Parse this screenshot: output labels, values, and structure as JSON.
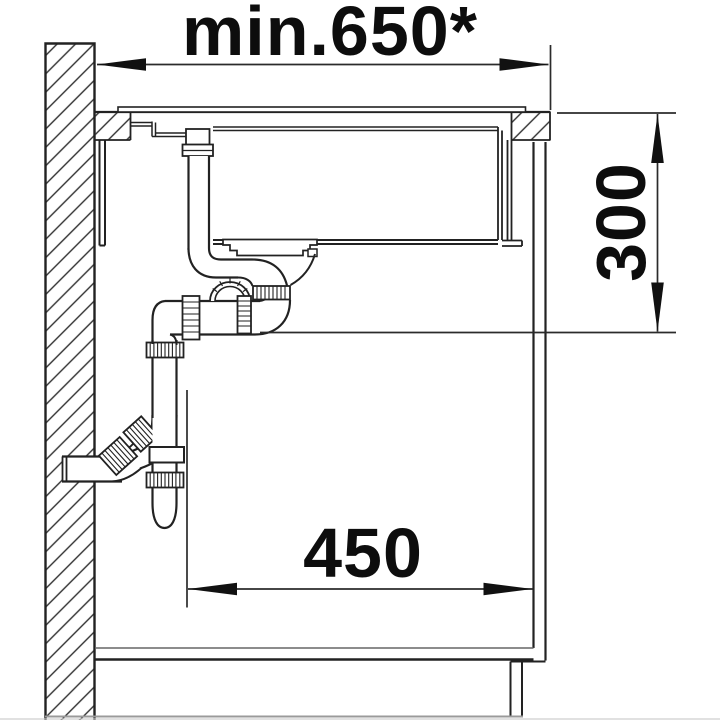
{
  "drawing": {
    "title": "sink-installation-cross-section",
    "dimensions": {
      "top_width": {
        "label": "min.650*",
        "orientation": "horizontal",
        "position": "top"
      },
      "bottom_width": {
        "label": "450",
        "orientation": "horizontal",
        "position": "bottom"
      },
      "right_height": {
        "label": "300",
        "orientation": "vertical",
        "position": "right"
      }
    },
    "colors": {
      "line": "#1f1f1f",
      "thin_line": "#3a3a3a",
      "dimension_line": "#2b2b2b",
      "text": "#0d0d0d",
      "ground": "#9a9a9a",
      "background": "#ffffff"
    },
    "elements": [
      "hatched-wall-section",
      "countertop-with-hatched-cut",
      "inset-sink-flange",
      "sink-bowl-with-strainer",
      "rear-drain-outlet-pipe",
      "siphon-trap-assembly",
      "wall-outlet-pipe",
      "base-cabinet-side-panel",
      "cabinet-floor-and-plinth"
    ]
  }
}
